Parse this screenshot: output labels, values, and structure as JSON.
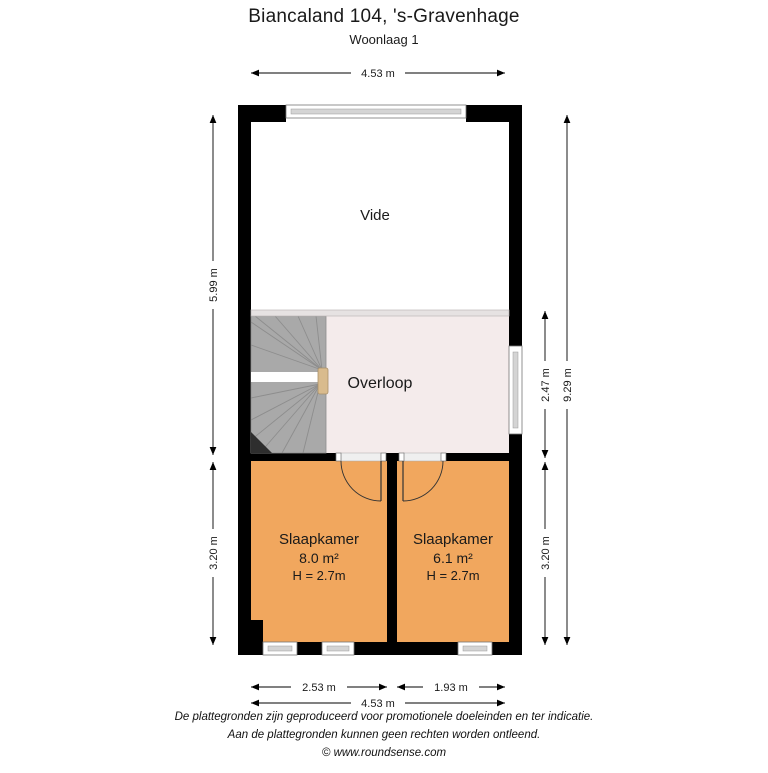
{
  "header": {
    "title": "Biancaland 104, 's-Gravenhage",
    "subtitle": "Woonlaag 1"
  },
  "rooms": {
    "vide": {
      "label": "Vide"
    },
    "overloop": {
      "label": "Overloop"
    },
    "slaapkamer_left": {
      "label": "Slaapkamer",
      "area": "8.0 m²",
      "ceiling": "H = 2.7m"
    },
    "slaapkamer_right": {
      "label": "Slaapkamer",
      "area": "6.1 m²",
      "ceiling": "H = 2.7m"
    }
  },
  "dimensions": {
    "top_width": "4.53 m",
    "left_upper_height": "5.99 m",
    "left_lower_height": "3.20 m",
    "right_overloop_height": "2.47 m",
    "right_total_height": "9.29 m",
    "right_lower_height": "3.20 m",
    "bottom_left_width": "2.53 m",
    "bottom_right_width": "1.93 m",
    "bottom_total_width": "4.53 m"
  },
  "colors": {
    "wall": "#000000",
    "bedroom_floor": "#f1a75e",
    "overloop_floor": "#f4ebeb",
    "vide_floor": "#ffffff",
    "stairs": "#a9a9a9",
    "stair_line": "#8d8d8d",
    "window_glass": "#d4d4d4",
    "handrail": "#d9bb8d",
    "railing": "#e6e2e2"
  },
  "footer": {
    "line1": "De plattegronden zijn geproduceerd voor promotionele doeleinden en ter indicatie.",
    "line2": "Aan de plattegronden kunnen geen rechten worden ontleend.",
    "line3": "© www.roundsense.com"
  }
}
